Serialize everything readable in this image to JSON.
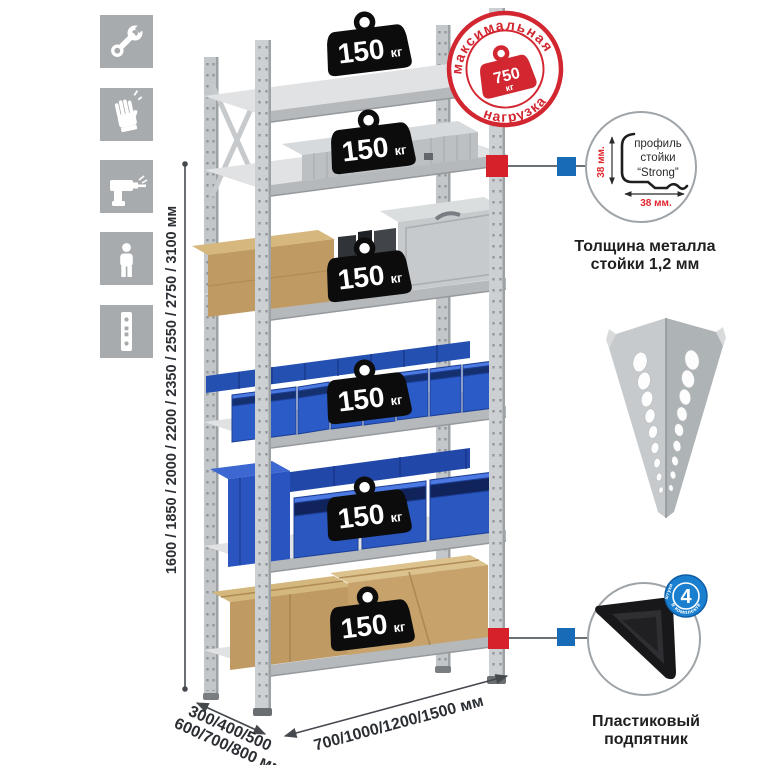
{
  "sidebar": {
    "icons": [
      {
        "name": "wrench-icon"
      },
      {
        "name": "gloves-icon"
      },
      {
        "name": "drill-icon"
      },
      {
        "name": "person-icon"
      },
      {
        "name": "upright-post-icon"
      }
    ],
    "tile_color": "#a7abae"
  },
  "dims": {
    "height": "1600 / 1850 / 2000 / 2200 / 2350 / 2550 / 2750 / 3100 мм",
    "depth1": "300/400/500",
    "depth2": "600/700/800 мм",
    "width": "700/1000/1200/1500 мм"
  },
  "badge": {
    "value": "150",
    "unit": "кг",
    "count": 6
  },
  "stamp": {
    "top": "максимальная",
    "bottom": "нагрузка",
    "value": "750",
    "unit": "кг",
    "color": "#d22630"
  },
  "profile": {
    "l1": "профиль",
    "l2": "стойки",
    "l3": "“Strong”",
    "dim_v": "38 мм.",
    "dim_h": "38 мм.",
    "cap1": "Толщина металла",
    "cap2": "стойки 1,2 мм"
  },
  "foot": {
    "cap1": "Пластиковый",
    "cap2": "подпятник",
    "num": "4",
    "arc": "в комплекте",
    "arc2": "штуки"
  },
  "colors": {
    "accent_red": "#d6212b",
    "accent_blue": "#176bb7",
    "bin_blue": "#2a5bc6",
    "metal": "#ccd0d2",
    "cardboard": "#bf9a62"
  }
}
